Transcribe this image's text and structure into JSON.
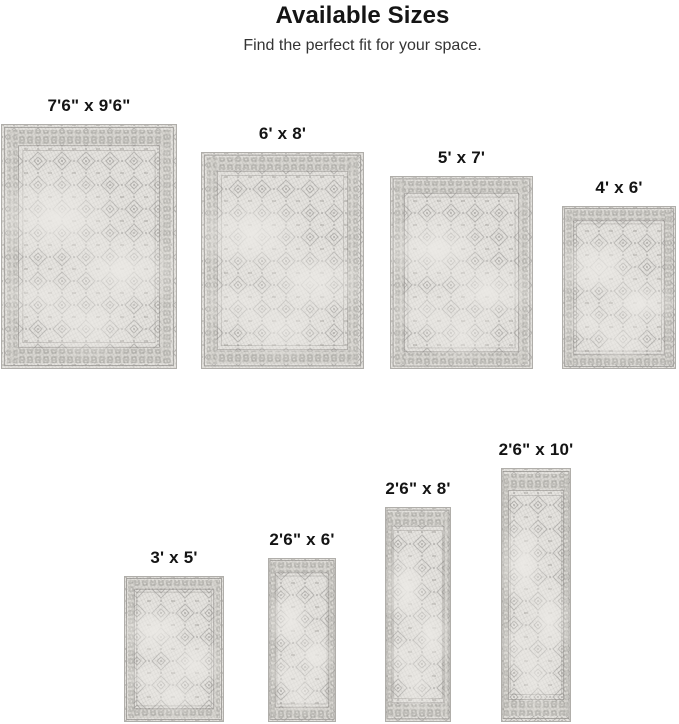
{
  "header": {
    "title": "Available Sizes",
    "subtitle": "Find the perfect fit for your space."
  },
  "rugs": [
    {
      "label": "7'6\" x 9'6\""
    },
    {
      "label": "6' x 8'"
    },
    {
      "label": "5' x 7'"
    },
    {
      "label": "4' x 6'"
    },
    {
      "label": "3' x 5'"
    },
    {
      "label": "2'6\" x 6'"
    },
    {
      "label": "2'6\" x 8'"
    },
    {
      "label": "2'6\" x 10'"
    }
  ],
  "colors": {
    "background": "#ffffff",
    "title_text": "#151515",
    "subtitle_text": "#343434",
    "label_text": "#141414",
    "rug_base": "#e5e3df",
    "rug_motif": "#8d8b87",
    "rug_band": "#d8d6d1",
    "rug_edge": "#b0aeaa"
  }
}
